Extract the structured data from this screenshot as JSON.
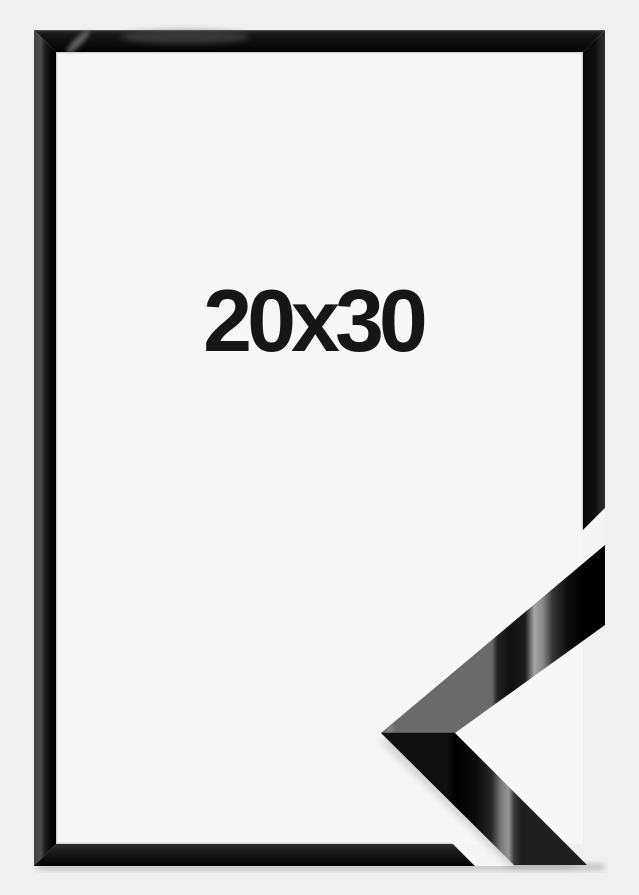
{
  "product_image": {
    "size_label": "20x30",
    "colors": {
      "background": "#f0f0f1",
      "interior": "#f7f7f8",
      "frame_black": "#0a0a0a",
      "text": "#161616",
      "gloss_highlight": "#a6a6a6",
      "gap_white": "#f5f5f6"
    }
  }
}
